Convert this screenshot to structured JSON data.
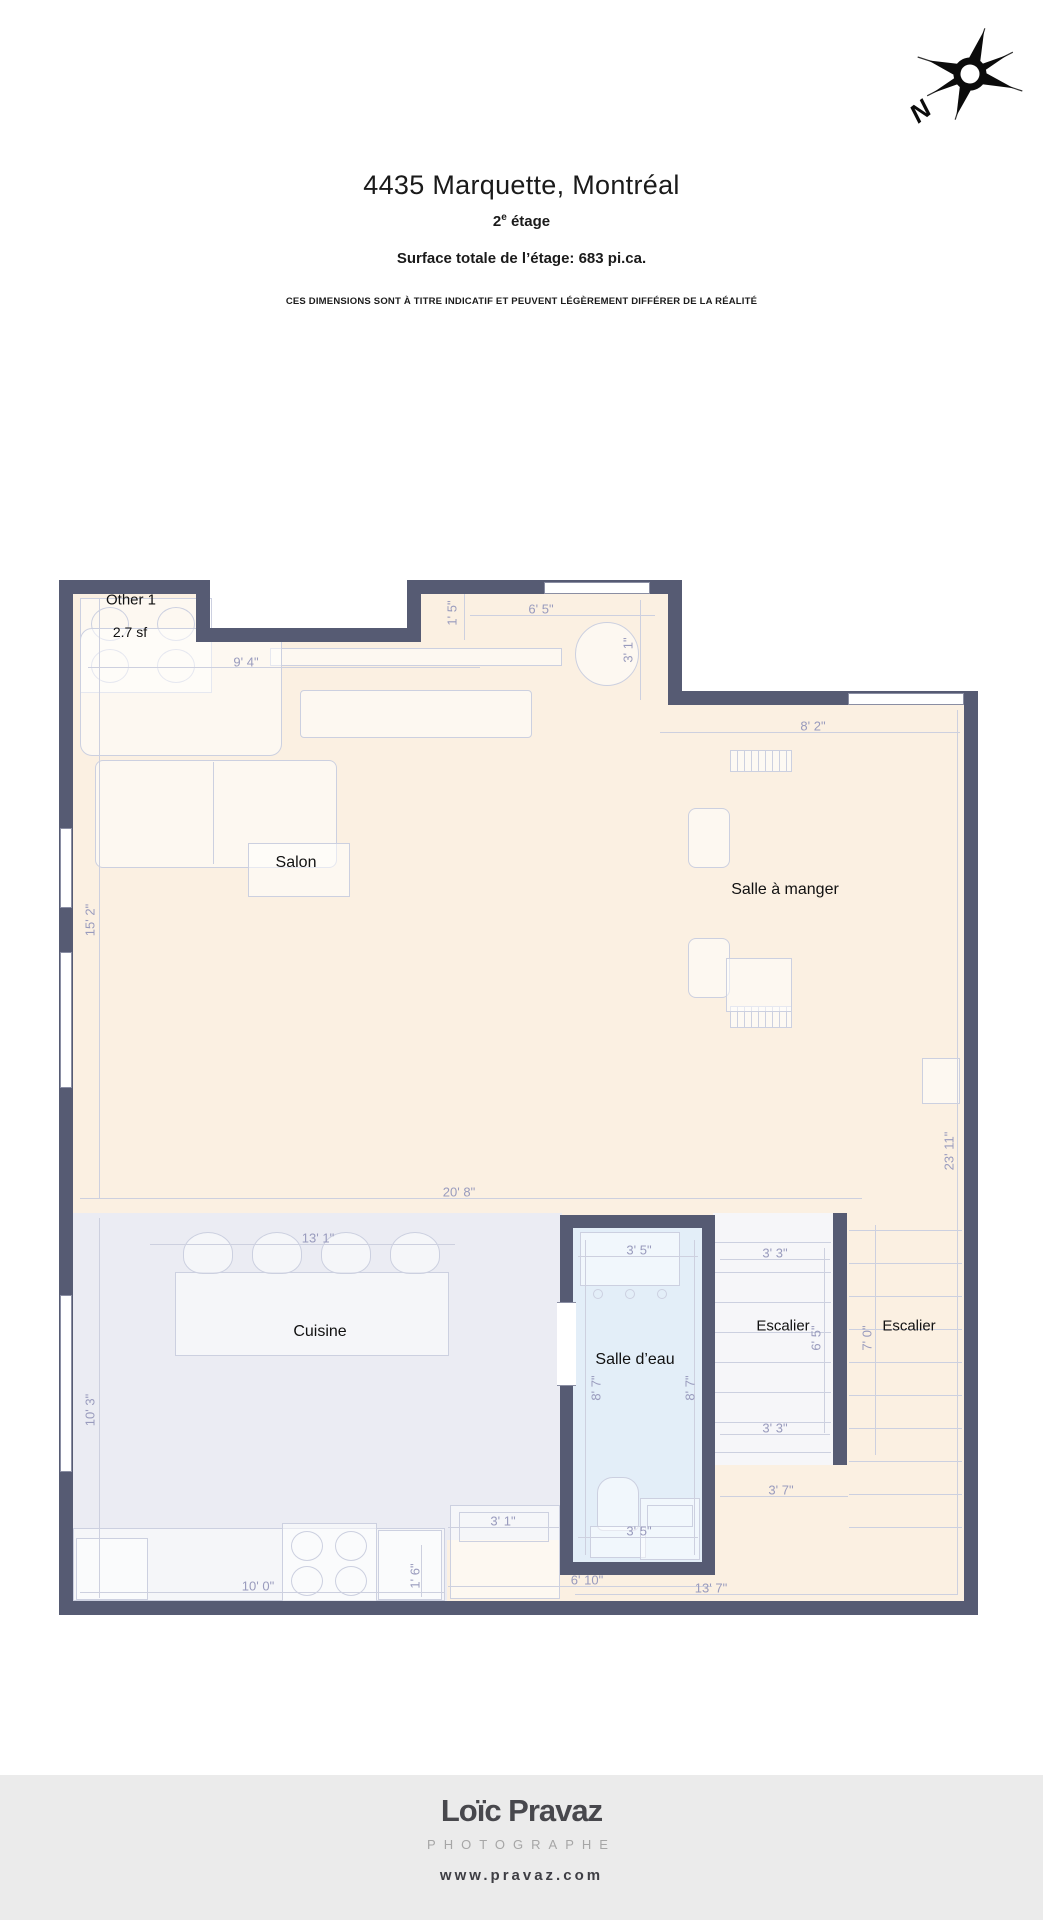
{
  "header": {
    "title": "4435 Marquette, Montréal",
    "floor_number": "2",
    "floor_exponent": "e",
    "floor_word": "étage",
    "surface_line": "Surface totale de l’étage: 683 pi.ca.",
    "disclaimer": "CES DIMENSIONS SONT À TITRE INDICATIF ET PEUVENT LÉGÈREMENT DIFFÉRER DE LA RÉALITÉ"
  },
  "compass": {
    "north_label": "N"
  },
  "colors": {
    "wall": "#565b73",
    "floor_main": "#fbf0e2",
    "floor_kitchen": "#ebecf3",
    "floor_bathroom": "#e3eef8",
    "floor_stairs": "#f6f6f9",
    "dimension_text": "#999bbd"
  },
  "plan": {
    "room_labels": [
      {
        "text": "Other 1",
        "x": 131,
        "y": 600,
        "size": 15
      },
      {
        "text": "2.7 sf",
        "x": 130,
        "y": 632,
        "size": 14
      },
      {
        "text": "Salon",
        "x": 296,
        "y": 863,
        "size": 16
      },
      {
        "text": "Salle à manger",
        "x": 785,
        "y": 890,
        "size": 16
      },
      {
        "text": "Cuisine",
        "x": 320,
        "y": 1332,
        "size": 16
      },
      {
        "text": "Salle d’eau",
        "x": 635,
        "y": 1360,
        "size": 16
      },
      {
        "text": "Escalier",
        "x": 783,
        "y": 1326,
        "size": 15
      },
      {
        "text": "Escalier",
        "x": 909,
        "y": 1326,
        "size": 15
      }
    ],
    "dimensions": [
      {
        "text": "9' 4\"",
        "x": 246,
        "y": 662,
        "v": false,
        "line": {
          "x": 88,
          "y": 667,
          "len": 392
        }
      },
      {
        "text": "1' 5\"",
        "x": 452,
        "y": 613,
        "v": true,
        "line": {
          "x": 464,
          "y": 592,
          "len": 48
        }
      },
      {
        "text": "6' 5\"",
        "x": 541,
        "y": 609,
        "v": false,
        "line": {
          "x": 470,
          "y": 615,
          "len": 185
        }
      },
      {
        "text": "3' 1\"",
        "x": 628,
        "y": 650,
        "v": true,
        "line": {
          "x": 640,
          "y": 600,
          "len": 100
        }
      },
      {
        "text": "8' 2\"",
        "x": 813,
        "y": 726,
        "v": false,
        "line": {
          "x": 660,
          "y": 732,
          "len": 300
        }
      },
      {
        "text": "15' 2\"",
        "x": 90,
        "y": 920,
        "v": true,
        "line": {
          "x": 99,
          "y": 598,
          "len": 600
        }
      },
      {
        "text": "23' 11\"",
        "x": 949,
        "y": 1151,
        "v": true,
        "line": {
          "x": 957,
          "y": 710,
          "len": 885
        }
      },
      {
        "text": "20' 8\"",
        "x": 459,
        "y": 1192,
        "v": false,
        "line": {
          "x": 80,
          "y": 1198,
          "len": 782
        }
      },
      {
        "text": "13' 1\"",
        "x": 318,
        "y": 1238,
        "v": false,
        "line": {
          "x": 150,
          "y": 1244,
          "len": 305
        }
      },
      {
        "text": "10' 3\"",
        "x": 90,
        "y": 1410,
        "v": true,
        "line": {
          "x": 99,
          "y": 1218,
          "len": 380
        }
      },
      {
        "text": "3' 5\"",
        "x": 639,
        "y": 1250,
        "v": false,
        "line": {
          "x": 578,
          "y": 1256,
          "len": 120
        }
      },
      {
        "text": "8' 7\"",
        "x": 596,
        "y": 1388,
        "v": true,
        "line": {
          "x": 585,
          "y": 1240,
          "len": 315
        }
      },
      {
        "text": "8' 7\"",
        "x": 690,
        "y": 1388,
        "v": true,
        "line": {
          "x": 694,
          "y": 1240,
          "len": 315
        }
      },
      {
        "text": "3' 5\"",
        "x": 639,
        "y": 1531,
        "v": false,
        "line": {
          "x": 578,
          "y": 1537,
          "len": 120
        }
      },
      {
        "text": "3' 1\"",
        "x": 503,
        "y": 1521,
        "v": false,
        "line": {
          "x": 448,
          "y": 1527,
          "len": 112
        }
      },
      {
        "text": "10' 0\"",
        "x": 258,
        "y": 1586,
        "v": false,
        "line": {
          "x": 80,
          "y": 1592,
          "len": 365
        }
      },
      {
        "text": "1' 6\"",
        "x": 415,
        "y": 1576,
        "v": true,
        "line": {
          "x": 421,
          "y": 1545,
          "len": 52
        }
      },
      {
        "text": "6' 10\"",
        "x": 587,
        "y": 1580,
        "v": false,
        "line": {
          "x": 448,
          "y": 1586,
          "len": 264
        }
      },
      {
        "text": "13' 7\"",
        "x": 711,
        "y": 1588,
        "v": false,
        "line": {
          "x": 575,
          "y": 1594,
          "len": 383
        }
      },
      {
        "text": "3' 3\"",
        "x": 775,
        "y": 1253,
        "v": false,
        "line": {
          "x": 720,
          "y": 1259,
          "len": 110
        }
      },
      {
        "text": "3' 3\"",
        "x": 775,
        "y": 1428,
        "v": false,
        "line": {
          "x": 720,
          "y": 1434,
          "len": 110
        }
      },
      {
        "text": "6' 5\"",
        "x": 816,
        "y": 1338,
        "v": true,
        "line": {
          "x": 824,
          "y": 1248,
          "len": 185
        }
      },
      {
        "text": "7' 0\"",
        "x": 867,
        "y": 1338,
        "v": true,
        "line": {
          "x": 875,
          "y": 1225,
          "len": 230
        }
      },
      {
        "text": "3' 7\"",
        "x": 781,
        "y": 1490,
        "v": false,
        "line": {
          "x": 720,
          "y": 1496,
          "len": 128
        }
      }
    ],
    "stairs": [
      {
        "x": 715,
        "w": 116,
        "y0": 1242,
        "step": 30,
        "count": 8
      },
      {
        "x": 849,
        "w": 113,
        "y0": 1230,
        "step": 33,
        "count": 10
      }
    ]
  },
  "footer": {
    "logo_name": "Loïc Pravaz",
    "logo_tagline": "PHOTOGRAPHE",
    "website": "www.pravaz.com"
  }
}
